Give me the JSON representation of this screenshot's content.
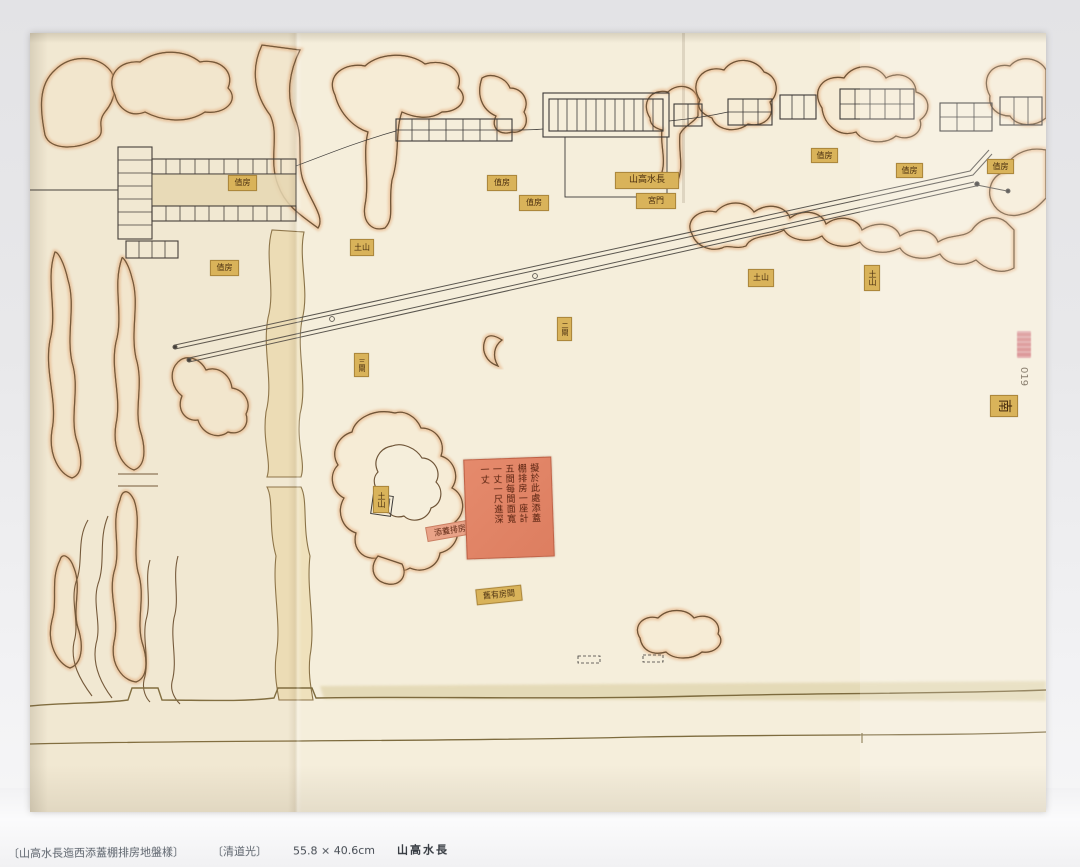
{
  "caption": {
    "title_bracketed": "〔山高水長迤西添蓋棚排房地盤樣〕",
    "era_bracketed": "〔清道光〕",
    "dimensions": "55.8 × 40.6cm",
    "site_name": "山高水長"
  },
  "map": {
    "orientation_label": "南",
    "plate_number": "019",
    "main_hall_label": "山高水長",
    "note_slip": {
      "columns": [
        "擬於此處添蓋",
        "棚排房一座計",
        "五間每間面寬",
        "一丈一尺進深",
        "一丈"
      ]
    },
    "labels": [
      {
        "text": "值房",
        "x": 198,
        "y": 142,
        "w": 27,
        "h": 14,
        "fs": 8,
        "style": "tag"
      },
      {
        "text": "值房",
        "x": 180,
        "y": 227,
        "w": 27,
        "h": 14,
        "fs": 8,
        "style": "tag"
      },
      {
        "text": "土山",
        "x": 320,
        "y": 206,
        "w": 22,
        "h": 15,
        "fs": 8,
        "style": "tag"
      },
      {
        "text": "值房",
        "x": 457,
        "y": 142,
        "w": 28,
        "h": 14,
        "fs": 8,
        "style": "tag"
      },
      {
        "text": "值房",
        "x": 489,
        "y": 162,
        "w": 28,
        "h": 14,
        "fs": 8,
        "style": "tag"
      },
      {
        "text": "山高水長",
        "x": 585,
        "y": 139,
        "w": 62,
        "h": 15,
        "fs": 9,
        "style": "tag"
      },
      {
        "text": "宮門",
        "x": 606,
        "y": 160,
        "w": 38,
        "h": 14,
        "fs": 8,
        "style": "tag"
      },
      {
        "text": "值房",
        "x": 781,
        "y": 115,
        "w": 25,
        "h": 13,
        "fs": 8,
        "style": "tag"
      },
      {
        "text": "值房",
        "x": 866,
        "y": 130,
        "w": 25,
        "h": 13,
        "fs": 8,
        "style": "tag"
      },
      {
        "text": "值房",
        "x": 957,
        "y": 126,
        "w": 25,
        "h": 13,
        "fs": 8,
        "style": "tag"
      },
      {
        "text": "土山",
        "x": 718,
        "y": 236,
        "w": 24,
        "h": 16,
        "fs": 8,
        "style": "tag"
      },
      {
        "text": "土山",
        "x": 834,
        "y": 232,
        "w": 14,
        "h": 24,
        "fs": 8,
        "style": "tag vert"
      },
      {
        "text": "三閘",
        "x": 324,
        "y": 320,
        "w": 13,
        "h": 22,
        "fs": 7,
        "style": "tag vert"
      },
      {
        "text": "二閘",
        "x": 527,
        "y": 284,
        "w": 13,
        "h": 22,
        "fs": 7,
        "style": "tag vert"
      },
      {
        "text": "土山",
        "x": 343,
        "y": 453,
        "w": 14,
        "h": 25,
        "fs": 8,
        "style": "tag vert"
      },
      {
        "text": "添蓋排房",
        "x": 396,
        "y": 490,
        "w": 46,
        "h": 13,
        "fs": 8,
        "style": "pink",
        "rot": -10
      },
      {
        "text": "舊有房間",
        "x": 446,
        "y": 554,
        "w": 44,
        "h": 14,
        "fs": 8,
        "style": "tag",
        "rot": -6
      },
      {
        "text": "南",
        "x": 963,
        "y": 359,
        "w": 20,
        "h": 26,
        "fs": 14,
        "style": "tag",
        "rot": 90
      },
      {
        "text": "019",
        "x": 986,
        "y": 330,
        "w": 14,
        "h": 28,
        "fs": 10,
        "style": "plain vert",
        "rot": 0
      }
    ]
  },
  "colors": {
    "paper": "#f5eedb",
    "hill_fill": "#f6ecd6",
    "hill_edge": "#e2a877",
    "ink": "#6a5138",
    "tag_bg": "#d9b35a",
    "slip_bg": "#e2836a"
  }
}
